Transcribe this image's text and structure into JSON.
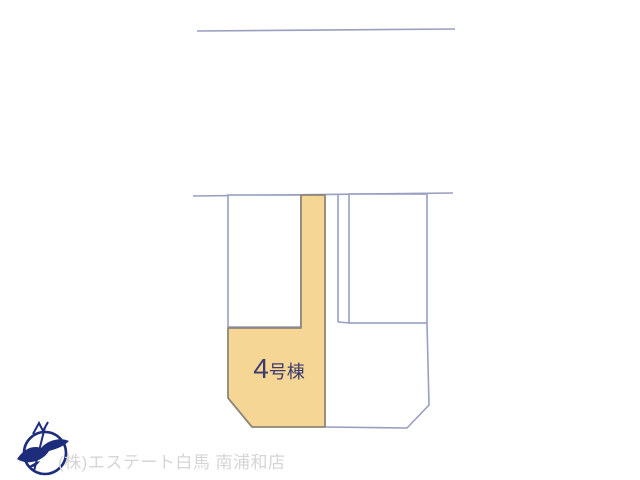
{
  "map": {
    "highlighted_lot": {
      "number": "4",
      "suffix": "号棟",
      "full_label": "4号棟"
    }
  },
  "footer": {
    "company_name": "(株)エステート白馬 南浦和店"
  },
  "icons": {
    "logo": "compass-bird-logo-icon"
  },
  "colors": {
    "background": "#ffffff",
    "boundary_line": "#989fc1",
    "lot_fill": "#f6d694",
    "lot_stroke": "#8d8679",
    "lot_label": "#3c3b6e",
    "logo_navy": "#1d2d7c",
    "footer_text": "#d5d5d5"
  }
}
